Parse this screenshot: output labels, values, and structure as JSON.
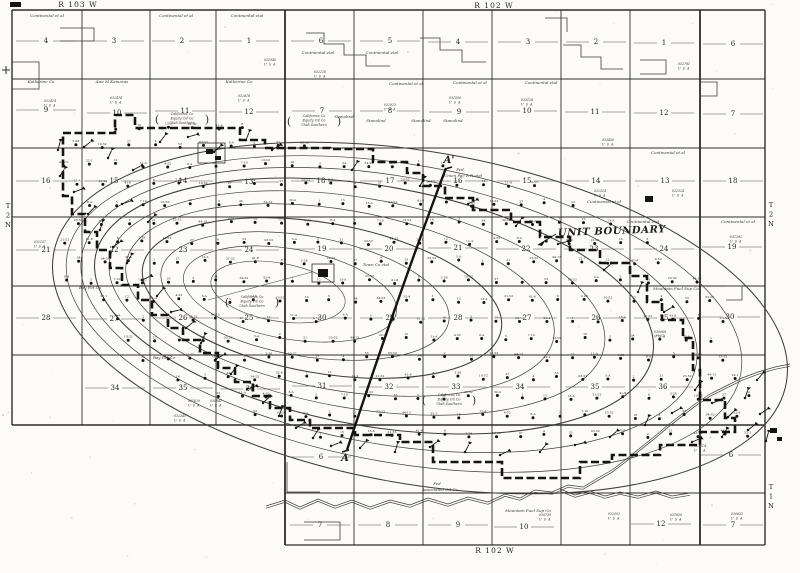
{
  "map": {
    "margin": {
      "top_left_range": {
        "text": "R 103 W",
        "x": 78,
        "y": 7
      },
      "top_right_range": {
        "text": "R 102 W",
        "x": 494,
        "y": 8
      },
      "bottom_range": {
        "text": "R 102 W",
        "x": 495,
        "y": 553
      },
      "left_township": {
        "chars": [
          "T",
          "2",
          "N"
        ],
        "x": 8,
        "y": 208
      },
      "right_township_top": {
        "chars": [
          "T",
          "2",
          "N"
        ],
        "x": 771,
        "y": 207
      },
      "right_township_bottom": {
        "chars": [
          "T",
          "1",
          "N"
        ],
        "x": 771,
        "y": 489
      }
    },
    "unit_boundary_label": {
      "text": "UNIT BOUNDARY",
      "x": 558,
      "y": 236
    },
    "cross_section": {
      "start_label": "A'",
      "sx": 449,
      "sy": 163,
      "end_label": "A",
      "ex": 345,
      "ey": 461,
      "path": "M446,168 Q400,290 347,450"
    },
    "ink": {
      "heavy": "#141412",
      "line": "#2e2e2c",
      "thin": "#55524e",
      "contour": "#403e39",
      "text": "#1f1f1d",
      "micro": "#3a3833"
    },
    "grid": {
      "v": [
        [
          12,
          10,
          425,
          1.4
        ],
        [
          82,
          10,
          425,
          0.9
        ],
        [
          150,
          10,
          425,
          0.9
        ],
        [
          216,
          10,
          425,
          0.9
        ],
        [
          285,
          10,
          545,
          1.8
        ],
        [
          354,
          10,
          545,
          0.9
        ],
        [
          423,
          10,
          545,
          0.9
        ],
        [
          492,
          10,
          545,
          0.9
        ],
        [
          561,
          10,
          545,
          0.9
        ],
        [
          630,
          10,
          545,
          0.9
        ],
        [
          700,
          10,
          545,
          1.8
        ],
        [
          765,
          10,
          545,
          1.4
        ]
      ],
      "h": [
        [
          10,
          12,
          765,
          1.4
        ],
        [
          79,
          12,
          765,
          0.9
        ],
        [
          148,
          12,
          765,
          0.9
        ],
        [
          217,
          12,
          765,
          0.9
        ],
        [
          286,
          12,
          765,
          0.9
        ],
        [
          355,
          12,
          765,
          0.9
        ],
        [
          425,
          12,
          765,
          1.5
        ],
        [
          493,
          285,
          765,
          0.9
        ],
        [
          545,
          285,
          765,
          1.2
        ]
      ]
    },
    "section_numbers": [
      [
        "4",
        46,
        43
      ],
      [
        "3",
        114,
        43
      ],
      [
        "2",
        182,
        43
      ],
      [
        "1",
        249,
        43
      ],
      [
        "9",
        46,
        112
      ],
      [
        "10",
        117,
        115
      ],
      [
        "11",
        185,
        113
      ],
      [
        "12",
        249,
        114
      ],
      [
        "16",
        46,
        183
      ],
      [
        "15",
        114,
        183
      ],
      [
        "14",
        183,
        183
      ],
      [
        "13",
        249,
        184
      ],
      [
        "21",
        46,
        252
      ],
      [
        "22",
        114,
        252
      ],
      [
        "23",
        183,
        252
      ],
      [
        "24",
        249,
        252
      ],
      [
        "28",
        46,
        320
      ],
      [
        "27",
        114,
        321
      ],
      [
        "26",
        183,
        320
      ],
      [
        "25",
        249,
        320
      ],
      [
        "34",
        115,
        390
      ],
      [
        "35",
        183,
        390
      ],
      [
        "36",
        250,
        391
      ],
      [
        "6",
        321,
        43
      ],
      [
        "5",
        390,
        43
      ],
      [
        "4",
        458,
        44
      ],
      [
        "3",
        528,
        44
      ],
      [
        "2",
        596,
        44
      ],
      [
        "1",
        664,
        45
      ],
      [
        "7",
        322,
        113
      ],
      [
        "8",
        390,
        113
      ],
      [
        "9",
        459,
        114
      ],
      [
        "10",
        527,
        113
      ],
      [
        "11",
        595,
        114
      ],
      [
        "12",
        664,
        115
      ],
      [
        "18",
        321,
        183
      ],
      [
        "17",
        390,
        183
      ],
      [
        "16",
        458,
        183
      ],
      [
        "15",
        527,
        183
      ],
      [
        "14",
        596,
        183
      ],
      [
        "13",
        665,
        183
      ],
      [
        "19",
        322,
        251
      ],
      [
        "20",
        389,
        251
      ],
      [
        "21",
        458,
        250
      ],
      [
        "22",
        526,
        251
      ],
      [
        "23",
        594,
        251
      ],
      [
        "24",
        664,
        251
      ],
      [
        "30",
        322,
        320
      ],
      [
        "29",
        390,
        320
      ],
      [
        "28",
        458,
        320
      ],
      [
        "27",
        527,
        320
      ],
      [
        "26",
        596,
        320
      ],
      [
        "25",
        664,
        320
      ],
      [
        "31",
        322,
        388
      ],
      [
        "32",
        389,
        389
      ],
      [
        "33",
        456,
        389
      ],
      [
        "34",
        520,
        389
      ],
      [
        "35",
        595,
        389
      ],
      [
        "36",
        663,
        389
      ],
      [
        "6",
        733,
        46
      ],
      [
        "7",
        733,
        116
      ],
      [
        "18",
        733,
        183
      ],
      [
        "19",
        732,
        249
      ],
      [
        "30",
        730,
        319
      ],
      [
        "6",
        321,
        459
      ],
      [
        "6",
        731,
        457
      ],
      [
        "7",
        320,
        527
      ],
      [
        "8",
        388,
        527
      ],
      [
        "9",
        458,
        527
      ],
      [
        "10",
        524,
        529
      ],
      [
        "12",
        661,
        526
      ],
      [
        "7",
        733,
        527
      ]
    ],
    "lease_labels": [
      [
        "Continental et al",
        47,
        17
      ],
      [
        "Continental et al",
        176,
        17
      ],
      [
        "Continental etal",
        247,
        17
      ],
      [
        "Continental etal",
        318,
        54
      ],
      [
        "Continental etal",
        382,
        54
      ],
      [
        "Continental et al",
        406,
        85
      ],
      [
        "Continental et al",
        470,
        84
      ],
      [
        "Continental etal",
        541,
        84
      ],
      [
        "Continental et al",
        668,
        154
      ],
      [
        "Continental et al",
        604,
        203
      ],
      [
        "Continental etal",
        643,
        223
      ],
      [
        "Continental et al",
        738,
        223
      ],
      [
        "Katherine Co",
        41,
        83
      ],
      [
        "Ana M Kamaras",
        112,
        83
      ],
      [
        "Katherine Co",
        239,
        83
      ],
      [
        "Stanolind",
        344,
        118
      ],
      [
        "Stanolind",
        376,
        122
      ],
      [
        "Stanolind",
        421,
        122
      ],
      [
        "Stanolind",
        453,
        122
      ],
      [
        "Town Co etal",
        376,
        266
      ],
      [
        "Mountain Fuel Sup Co",
        676,
        290
      ],
      [
        "Bay Pet Co",
        90,
        289
      ],
      [
        "Bay Pet Co",
        164,
        359
      ],
      [
        "Fed",
        460,
        171
      ],
      [
        "Union Pac R R etal",
        463,
        177
      ],
      [
        "Fed",
        437,
        485
      ],
      [
        "Associated Oil Co",
        440,
        491
      ],
      [
        "Mountain Fuel Sup Co",
        528,
        512
      ]
    ],
    "bracket_groups": {
      "lines": [
        "California Co",
        "Equity Oil Co",
        "Utah Southern"
      ],
      "at": [
        [
          314,
          117
        ],
        [
          182,
          115
        ],
        [
          252,
          298
        ],
        [
          449,
          396
        ]
      ]
    },
    "serial_suffix": "U S A",
    "serial_labels": [
      [
        50,
        102,
        "032414"
      ],
      [
        116,
        99,
        "032474"
      ],
      [
        244,
        97,
        "032618"
      ],
      [
        320,
        73,
        "032216"
      ],
      [
        390,
        106,
        "032923"
      ],
      [
        455,
        99,
        "031506"
      ],
      [
        527,
        101,
        "033128"
      ],
      [
        608,
        141,
        "033456"
      ],
      [
        600,
        192,
        "032514"
      ],
      [
        678,
        192,
        "032524"
      ],
      [
        736,
        238,
        "031282"
      ],
      [
        660,
        333,
        "030968"
      ],
      [
        700,
        447,
        "033514"
      ],
      [
        545,
        516,
        "030739"
      ],
      [
        614,
        515,
        "032092"
      ],
      [
        676,
        516,
        "031850"
      ],
      [
        737,
        515,
        "030633"
      ],
      [
        40,
        243,
        "032157"
      ],
      [
        194,
        402,
        "031629"
      ],
      [
        216,
        402,
        "030841"
      ],
      [
        180,
        417,
        "032345"
      ],
      [
        270,
        61,
        "031940"
      ],
      [
        684,
        65,
        "032781"
      ]
    ],
    "contours": [
      [
        420,
        318,
        372,
        166,
        10,
        1.05
      ],
      [
        404,
        314,
        342,
        149,
        10,
        0.7
      ],
      [
        389,
        310,
        312,
        134,
        10,
        0.7
      ],
      [
        374,
        306,
        283,
        120,
        10,
        1.05
      ],
      [
        357,
        303,
        251,
        105,
        10,
        0.7
      ],
      [
        340,
        300,
        217,
        90,
        10,
        0.7
      ],
      [
        322,
        298,
        182,
        75,
        10,
        1.05
      ],
      [
        305,
        296,
        146,
        60,
        10,
        0.7
      ],
      [
        290,
        294,
        108,
        45,
        10,
        0.65
      ],
      [
        278,
        292,
        68,
        29,
        10,
        0.6
      ]
    ],
    "well_regions": [
      [
        398,
        303,
        340,
        148,
        10
      ],
      [
        210,
        172,
        165,
        50,
        4
      ],
      [
        698,
        404,
        92,
        56,
        14
      ]
    ],
    "well_grid": {
      "x0": 40,
      "dx": 25.3,
      "y0": 127,
      "dy": 19.3,
      "rows": 18,
      "cols": 30,
      "row_shift": 12.6,
      "jitter": 2.2
    },
    "well_label_pool": [
      "1",
      "2",
      "3",
      "4",
      "5",
      "8",
      "12",
      "15",
      "21",
      "34",
      "53",
      "7-10",
      "2-28",
      "11-A",
      "13-A",
      "23-52",
      "34-52",
      "03-52",
      "13-52",
      "10-52",
      "4-52",
      "21-52",
      "44-13",
      "32-4",
      "5-A",
      "16",
      "27",
      "8-A",
      "41-8",
      "22-1"
    ],
    "flag_wells": [
      [
        58,
        150
      ],
      [
        84,
        147
      ],
      [
        108,
        158
      ],
      [
        133,
        170
      ],
      [
        160,
        142
      ],
      [
        188,
        137
      ],
      [
        214,
        152
      ],
      [
        246,
        140
      ],
      [
        272,
        150
      ],
      [
        60,
        176
      ],
      [
        74,
        192
      ],
      [
        88,
        214
      ],
      [
        100,
        230
      ],
      [
        113,
        247
      ],
      [
        127,
        263
      ],
      [
        142,
        280
      ],
      [
        157,
        296
      ],
      [
        171,
        312
      ],
      [
        186,
        328
      ],
      [
        201,
        343
      ],
      [
        216,
        359
      ],
      [
        231,
        374
      ],
      [
        247,
        389
      ],
      [
        263,
        403
      ],
      [
        279,
        416
      ],
      [
        296,
        428
      ],
      [
        313,
        438
      ],
      [
        331,
        446
      ],
      [
        360,
        448
      ],
      [
        395,
        452
      ],
      [
        430,
        447
      ],
      [
        465,
        452
      ],
      [
        500,
        455
      ],
      [
        540,
        452
      ],
      [
        575,
        445
      ],
      [
        610,
        437
      ],
      [
        645,
        425
      ],
      [
        672,
        413
      ],
      [
        695,
        390
      ],
      [
        712,
        403
      ],
      [
        728,
        417
      ],
      [
        745,
        398
      ],
      [
        760,
        414
      ],
      [
        722,
        437
      ],
      [
        692,
        442
      ],
      [
        757,
        380
      ],
      [
        766,
        441
      ],
      [
        748,
        430
      ],
      [
        420,
        186
      ],
      [
        468,
        204
      ],
      [
        516,
        226
      ],
      [
        558,
        244
      ],
      [
        604,
        270
      ],
      [
        638,
        292
      ],
      [
        664,
        312
      ],
      [
        352,
        170
      ],
      [
        122,
        204
      ],
      [
        148,
        222
      ]
    ],
    "unit_boundary_path": "M63,133 L115,133 115,115 135,115 135,128 240,128 240,140 265,140 265,148 330,148 330,149 373,149 373,162 407,162 407,173 423,173 423,186 445,186 445,198 473,198 473,210 511,210 511,222 540,222 540,237 570,237 570,250 600,250 600,263 630,263 630,276 647,276 647,302 662,302 662,320 683,320 683,338 693,338 693,370 700,370 700,400 725,400 725,418 735,418 735,432 700,432 700,445 660,445 660,455 612,455 612,462 580,462 580,478 502,478 502,462 433,462 433,442 400,442 400,435 355,435 355,428 310,428 310,420 290,420 290,408 270,408 270,396 253,396 253,382 235,382 235,368 218,368 218,353 200,353 200,340 183,340 183,328 168,328 168,315 152,315 152,300 138,300 138,285 122,285 122,268 110,268 110,250 97,250 97,232 85,232 85,214 72,214 72,196 63,196 Z",
    "creek_main": "M266,506 L285,500 300,507 318,499 335,506 352,500 370,507 390,500 410,505 428,498 448,504 468,497 488,502 505,494 520,498 535,490 552,492 568,485 583,487 598,478 612,470 625,460 640,448 655,436 668,425 682,414 695,404 710,394 726,386 742,378 758,372 775,367 790,364",
    "creek_branch": "M560,489 L575,495 590,491 605,496 620,492 638,496 656,491 672,496 690,493",
    "lease_lines": [
      "M60,28 h34 v13 h-34",
      "M306,33 h18 v11 h20 v11 h22 v11 h24",
      "M420,38 h20 v12 h22 v12 h24",
      "M563,45 h18 v12 h20 v12 h22",
      "M700,82 h17 v14 h-17",
      "M545,18 h22 v14",
      "M640,60 h26 v14 h-26",
      "M287,462 v30 h33",
      "M304,522 h36 v18 h-36",
      "M726,286 h16 v14 h-16",
      "M12,62 h27 v27 h-27"
    ],
    "buildings_filled": [
      [
        206,
        149,
        7,
        5
      ],
      [
        215,
        156,
        6,
        4
      ],
      [
        645,
        196,
        8,
        6
      ],
      [
        770,
        428,
        7,
        5
      ],
      [
        777,
        437,
        5,
        4
      ],
      [
        318,
        269,
        10,
        8
      ],
      [
        10,
        2,
        11,
        5
      ]
    ],
    "buildings_outline": [
      [
        198,
        143,
        27,
        20
      ],
      [
        312,
        264,
        22,
        18
      ]
    ],
    "road_line": [
      312,
      272,
      208,
      300
    ],
    "margin_cross": {
      "x": 6,
      "y": 70
    }
  }
}
